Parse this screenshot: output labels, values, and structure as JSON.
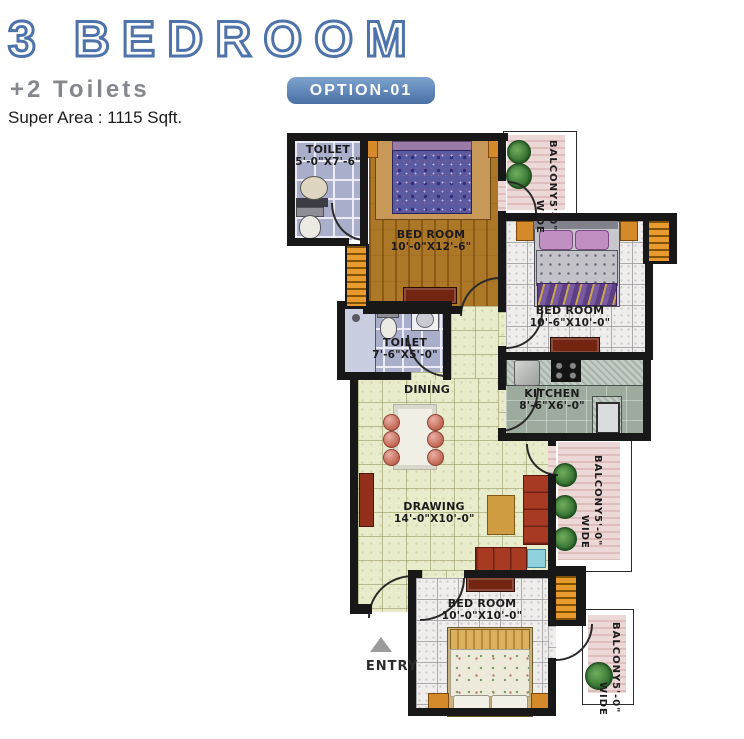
{
  "header": {
    "title": "3 BEDROOM",
    "subtitle": "+2 Toilets",
    "badge": "OPTION-01",
    "super_area": "Super Area : 1115 Sqft.",
    "title_color": "#4e73aa",
    "badge_color": "#5580b4",
    "subtitle_color": "#84888d"
  },
  "plan": {
    "entry_label": "ENTRY",
    "wall_color": "#181818",
    "rooms": [
      {
        "id": "toilet-1",
        "name": "TOILET",
        "dims": "5'-0\"X7'-6\""
      },
      {
        "id": "bedroom-1",
        "name": "BED ROOM",
        "dims": "10'-0\"X12'-6\""
      },
      {
        "id": "balcony-top",
        "name": "BALCONY",
        "dims": "5'-0\" WIDE"
      },
      {
        "id": "bedroom-2",
        "name": "BED ROOM",
        "dims": "10'-6\"X10'-0\""
      },
      {
        "id": "toilet-2",
        "name": "TOILET",
        "dims": "7'-6\"X5'-0\""
      },
      {
        "id": "dining",
        "name": "DINING",
        "dims": ""
      },
      {
        "id": "kitchen",
        "name": "KITCHEN",
        "dims": "8'-6\"X6'-0\""
      },
      {
        "id": "balcony-mid",
        "name": "BALCONY",
        "dims": "5'-0\" WIDE"
      },
      {
        "id": "drawing",
        "name": "DRAWING",
        "dims": "14'-0\"X10'-0\""
      },
      {
        "id": "bedroom-3",
        "name": "BED ROOM",
        "dims": "10'-0\"X10'-0\""
      },
      {
        "id": "balcony-bottom",
        "name": "BALCONY",
        "dims": "5'-0\" WIDE"
      }
    ]
  }
}
